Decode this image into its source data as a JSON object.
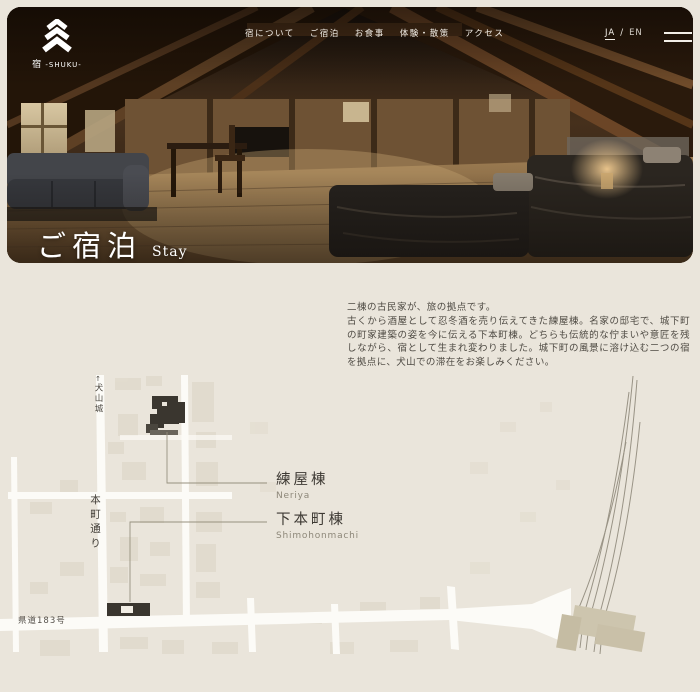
{
  "brand": {
    "jp": "宿",
    "roman": "-SHUKU-"
  },
  "header": {
    "nav": [
      {
        "label": "宿について"
      },
      {
        "label": "ご宿泊"
      },
      {
        "label": "お食事"
      },
      {
        "label": "体験・散策"
      },
      {
        "label": "アクセス"
      }
    ],
    "lang": {
      "ja": "JA",
      "sep": "/",
      "en": "EN"
    }
  },
  "hero": {
    "title": "ご宿泊",
    "subtitle": "Stay"
  },
  "intro": {
    "lead": "二棟の古民家が、旅の拠点です。",
    "body": "古くから酒屋として忍冬酒を売り伝えてきた練屋棟。名家の邸宅で、城下町の町家建築の姿を今に伝える下本町棟。どちらも伝統的な佇まいや意匠を残しながら、宿として生まれ変わりました。城下町の風景に溶け込む二つの宿を拠点に、犬山での滞在をお楽しみください。"
  },
  "map": {
    "castle_arrow": "↑",
    "castle": "犬山城",
    "street": "本町通り",
    "route": "県道183号",
    "markers": [
      {
        "jp": "練屋棟",
        "en": "Neriya"
      },
      {
        "jp": "下本町棟",
        "en": "Shimohonmachi"
      }
    ],
    "colors": {
      "page_bg": "#eae5db",
      "road": "#fcfbf7",
      "building": "#dcd6c7",
      "marker_dark": "#3a362f",
      "leader_line": "#97917f",
      "rail": "#8b8577",
      "station": "#cdc5ae",
      "label_text": "#45413a",
      "label_sub": "#8d8779"
    }
  }
}
